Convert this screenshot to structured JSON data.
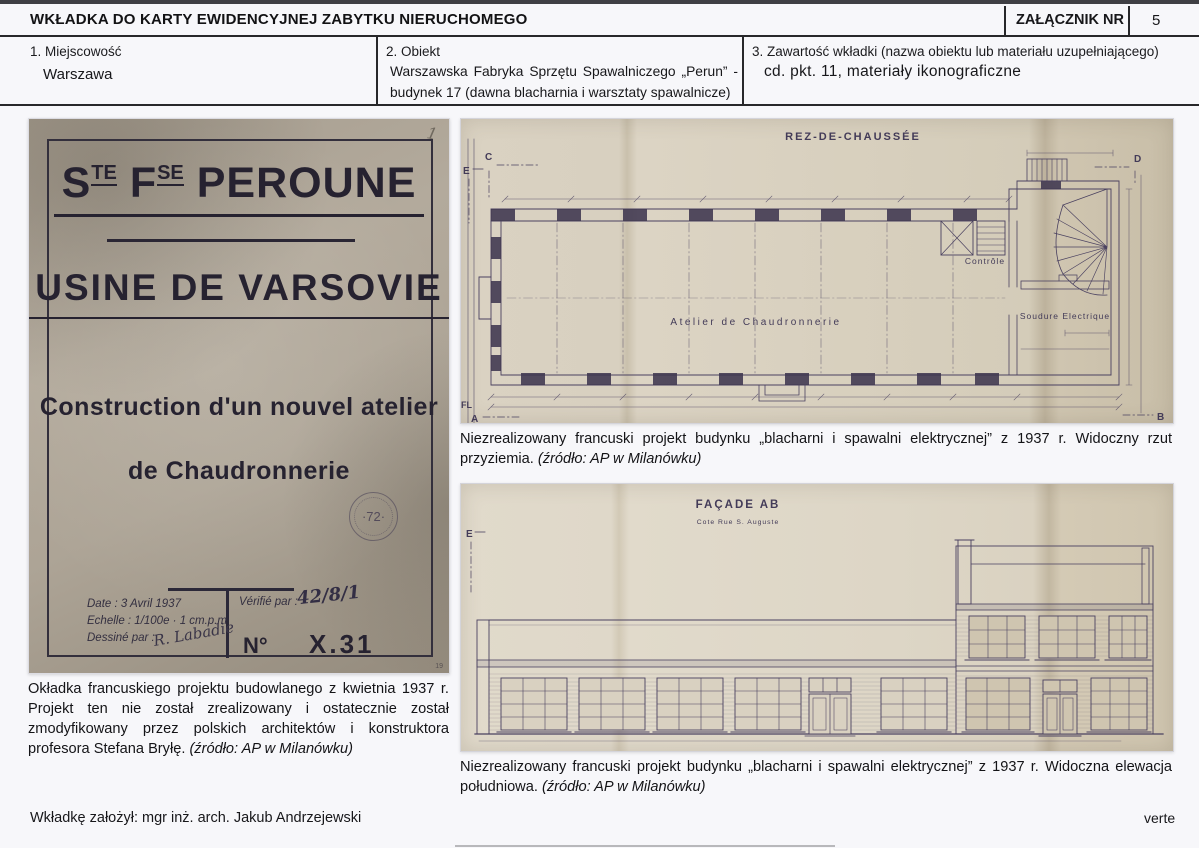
{
  "header": {
    "title": "WKŁADKA DO KARTY EWIDENCYJNEJ ZABYTKU NIERUCHOMEGO",
    "attachment_label": "ZAŁĄCZNIK NR",
    "attachment_number": "5",
    "fields": [
      {
        "label": "1. Miejscowość",
        "value": "Warszawa"
      },
      {
        "label": "2. Obiekt",
        "value": "Warszawska Fabryka Sprzętu Spawalniczego „Perun” - budynek 17 (dawna blacharnia i warsztaty spawalnicze)"
      },
      {
        "label": "3. Zawartość wkładki (nazwa obiektu lub materiału uzupełniającego)",
        "value": "cd. pkt. 11, materiały ikonograficzne"
      }
    ]
  },
  "cover_photo": {
    "company_s": "S",
    "company_te": "TE",
    "company_f": "F",
    "company_se": "SE",
    "company_name": " PEROUNE",
    "line2": "USINE DE VARSOVIE",
    "line3": "Construction d'un nouvel atelier",
    "line4": "de Chaudronnerie",
    "stamp": "·72·",
    "page_mark": "1",
    "date": "Date : 3 Avril 1937",
    "scale": "Echelle : 1/100e · 1 cm.p.m",
    "drawn_by": "Dessiné par :",
    "signature": "R. Labadie",
    "verified_by": "Vérifié par :",
    "verified_note": "42/8/1",
    "number_label": "N°",
    "number_value": "X.31",
    "corner_mark": "19"
  },
  "plan_drawing": {
    "title": "REZ-DE-CHAUSSÉE",
    "room_main": "Atelier  de  Chaudronnerie",
    "room_control": "Contrôle",
    "room_welding": "Soudure  Electrique",
    "marker_c": "C",
    "marker_d": "D",
    "marker_e": "E",
    "marker_fl": "FL",
    "marker_a": "A",
    "marker_b": "B"
  },
  "facade_drawing": {
    "title": "FAÇADE  AB",
    "subtitle": "Cote  Rue  S. Auguste",
    "marker_e": "E"
  },
  "captions": {
    "cover": "Okładka francuskiego projektu budowlanego z kwietnia 1937 r. Projekt ten nie został zrealizowany i ostatecznie został zmodyfikowany przez polskich architektów i konstruktora profesora Stefana Bryłę.",
    "cover_source": "(źródło: AP w Milanówku)",
    "plan": "Niezrealizowany francuski projekt budynku „blacharni i spawalni elektrycznej” z 1937 r. Widoczny rzut przyziemia.",
    "plan_source": "(źródło: AP w Milanówku)",
    "facade": "Niezrealizowany francuski projekt budynku „blacharni i spawalni elektrycznej” z 1937 r. Widoczna elewacja południowa.",
    "facade_source": "(źródło: AP w Milanówku)"
  },
  "footer": {
    "created_by": "Wkładkę założył: mgr inż. arch. Jakub Andrzejewski",
    "verte": "verte"
  },
  "colors": {
    "ink_drawing": "#4a4160",
    "ink_cover": "#262230",
    "paper_plan": "#d6cebc",
    "paper_cover": "#aca395",
    "rule": "#27272a"
  }
}
